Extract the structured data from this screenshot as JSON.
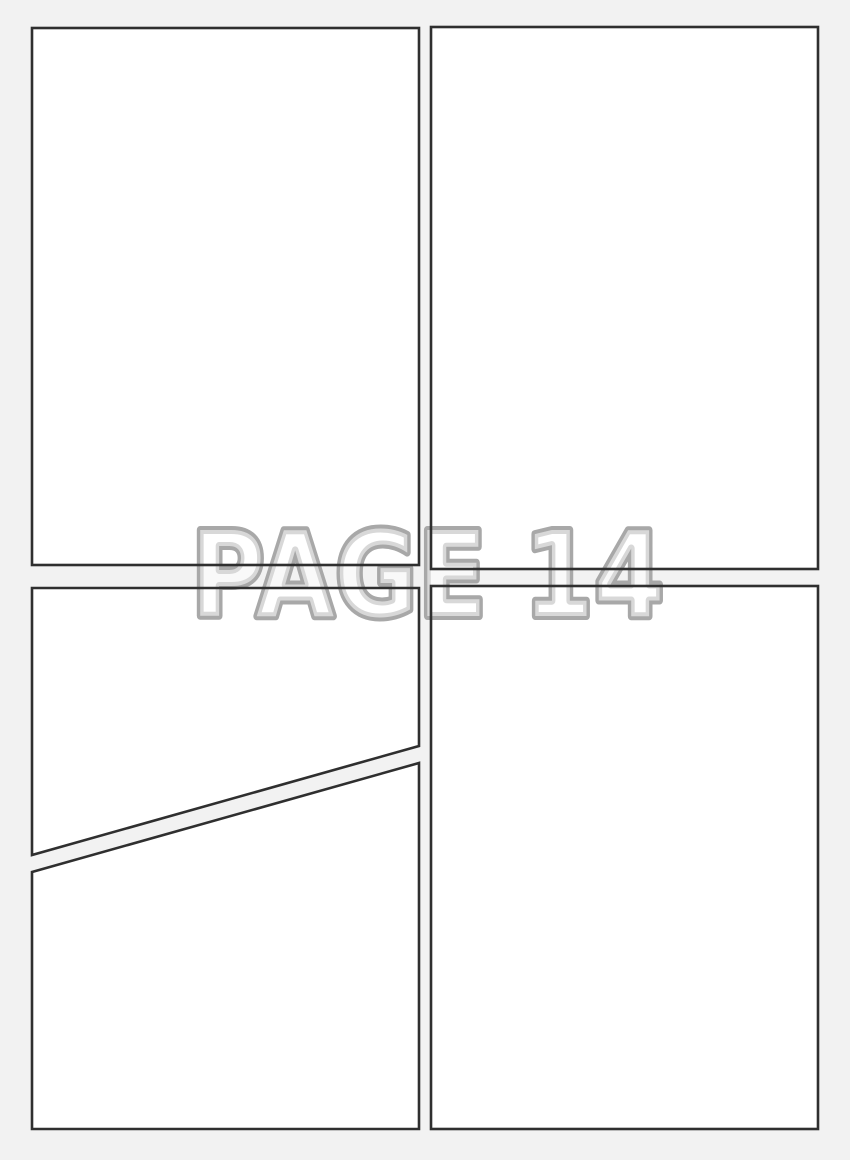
{
  "page": {
    "label": "PAGE 14",
    "colors": {
      "background": "#f2f2f2",
      "panel_fill": "#ffffff",
      "panel_border": "#2f2f2f",
      "label_outline": "#a8a8a8",
      "label_fill": "rgba(255,255,255,0.55)"
    },
    "panels": [
      {
        "name": "top-left"
      },
      {
        "name": "top-right"
      },
      {
        "name": "middle-left-above-diagonal"
      },
      {
        "name": "bottom-left-below-diagonal"
      },
      {
        "name": "bottom-right"
      }
    ]
  }
}
